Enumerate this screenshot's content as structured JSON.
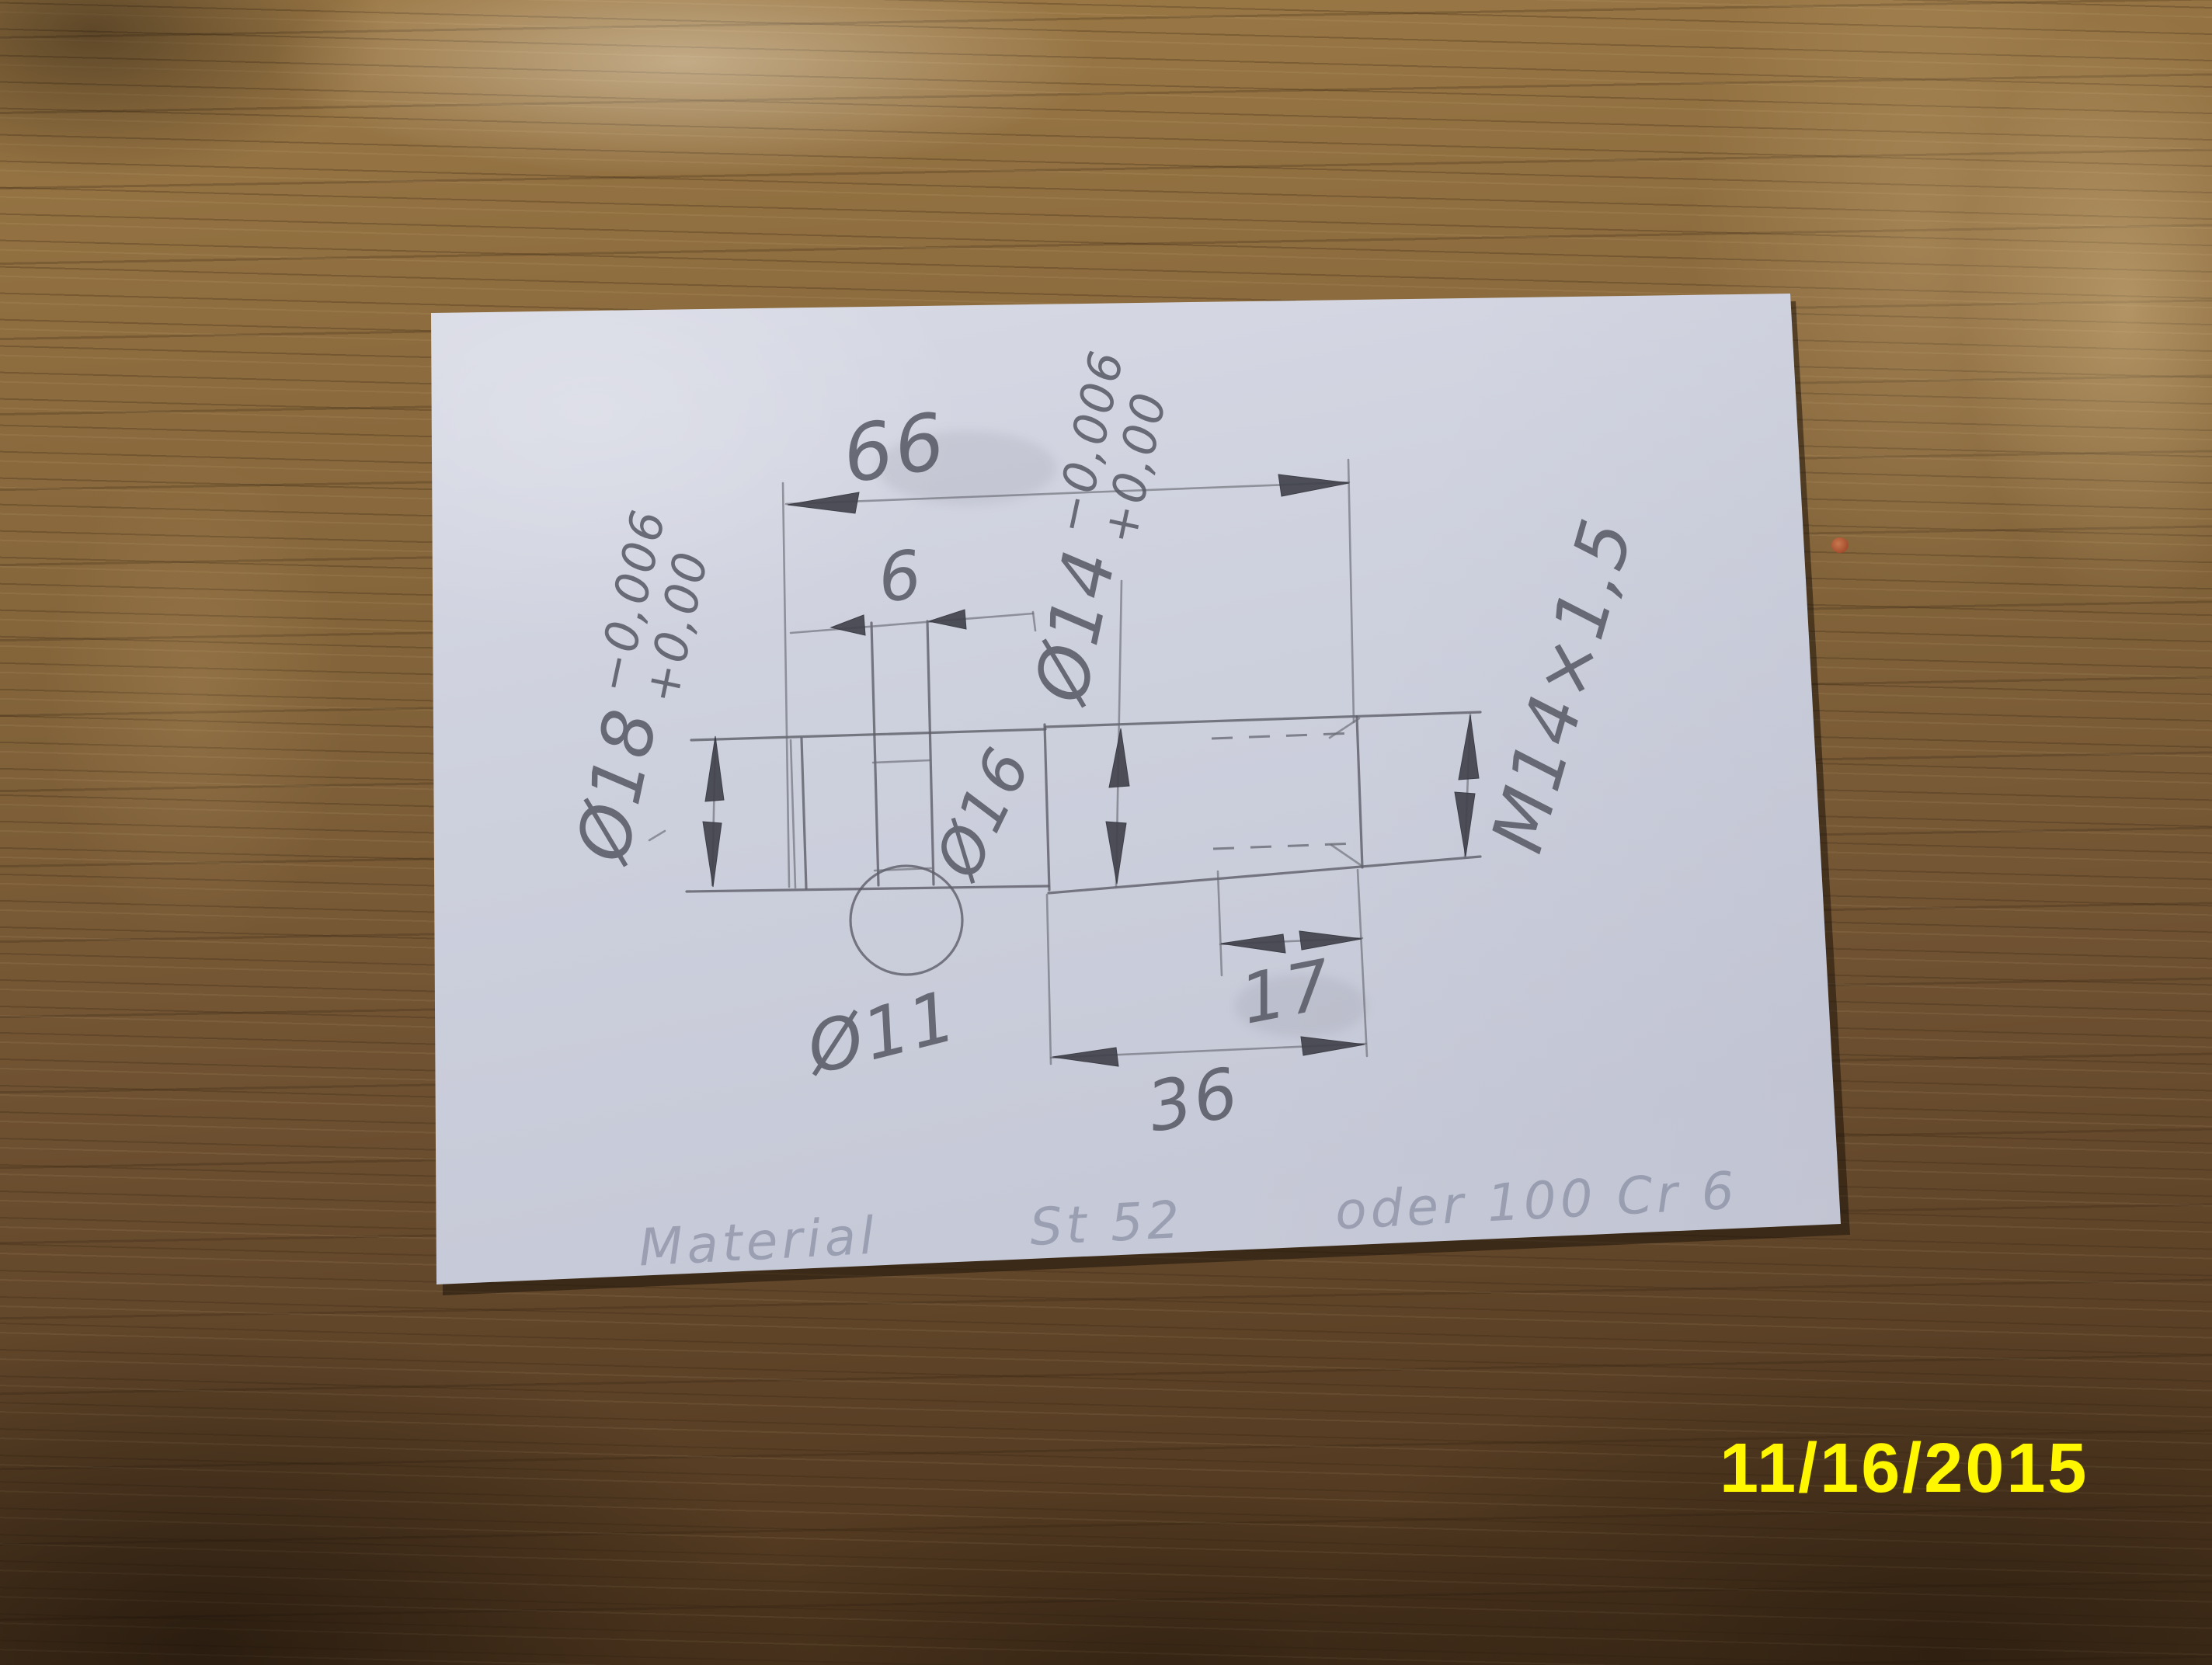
{
  "photo": {
    "timestamp": {
      "text": "11/16/2015",
      "color": "#fff700"
    },
    "colors": {
      "paper": "#ced1de",
      "wood": "#7a5c36",
      "pencil": "#5a5c66"
    }
  },
  "sketch": {
    "dim_66": {
      "value": "66"
    },
    "dim_6": {
      "value": "6"
    },
    "dim_17": {
      "value": "17"
    },
    "dim_36": {
      "value": "36"
    },
    "dia18": {
      "text": "Ø18",
      "tol_upper": "−0,006",
      "tol_lower": "+0,00"
    },
    "dia14": {
      "text": "Ø14",
      "tol_upper": "−0,006",
      "tol_lower": "+0,00"
    },
    "dia16": {
      "text": "Ø16"
    },
    "dia11": {
      "text": "Ø11"
    },
    "thread": {
      "text": "M14×1,5"
    },
    "material_note": {
      "word1": "Material",
      "word2": "St 52",
      "word3": "oder 100 Cr 6"
    }
  }
}
